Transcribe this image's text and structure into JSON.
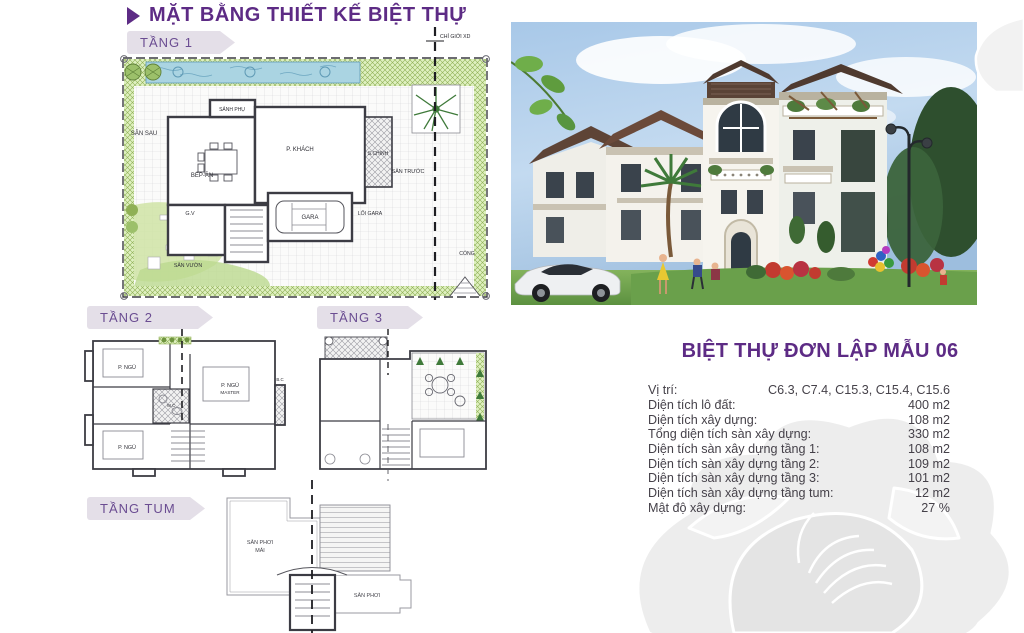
{
  "header": {
    "title": "MẶT BẰNG THIẾT KẾ BIỆT THỰ"
  },
  "floors": {
    "tang1": {
      "label": "TẦNG 1"
    },
    "tang2": {
      "label": "TẦNG 2"
    },
    "tang3": {
      "label": "TẦNG 3"
    },
    "tangtum": {
      "label": "TẦNG TUM"
    }
  },
  "plan1": {
    "boundary_note": "CHỈ GIỚI XD",
    "rooms": {
      "san_sau": "SÂN SAU",
      "bep_an": "BẾP-ĂN",
      "sanh_phu": "SẢNH PHỤ",
      "p_khach": "P. KHÁCH",
      "s_chinh": "S.CHÍNH",
      "gv": "G.V",
      "gara": "GARA",
      "loi_gara": "LỐI GARA",
      "san_vuon": "SÂN VƯỜN",
      "san_truoc": "SÂN TRƯỚC",
      "cong": "CỔNG"
    }
  },
  "plan2": {
    "rooms": {
      "bed1": "P. NGỦ",
      "bed2": "P. NGỦ",
      "master1": "P. NGỦ",
      "master2": "MASTER",
      "wc": "W.C",
      "balcony": "B.C"
    }
  },
  "plantum": {
    "rooms": {
      "left1": "SÂN PHƠI",
      "left2": "MÁI",
      "right": "SÂN PHƠI"
    }
  },
  "specs": {
    "title": "BIỆT THỰ ĐƠN LẬP MẪU 06",
    "rows": [
      {
        "label": "Vị trí:",
        "value": "C6.3, C7.4, C15.3, C15.4, C15.6"
      },
      {
        "label": "Diện tích lô đất:",
        "value": "400 m2"
      },
      {
        "label": "Diện tích xây dựng:",
        "value": "108 m2"
      },
      {
        "label": "Tổng diện tích sàn xây dựng:",
        "value": "330 m2"
      },
      {
        "label": "Diện tích sàn xây dựng tầng 1:",
        "value": "108 m2"
      },
      {
        "label": "Diện tích sàn xây dựng tầng 2:",
        "value": "109 m2"
      },
      {
        "label": "Diện tích sàn xây dựng tầng 3:",
        "value": "101 m2"
      },
      {
        "label": "Diện tích sàn xây dựng tầng tum:",
        "value": "12 m2"
      },
      {
        "label": "Mật độ xây dựng:",
        "value": "27 %"
      }
    ]
  },
  "colors": {
    "accent_purple": "#5d2b85",
    "banner_bg": "#e4dfe8",
    "banner_text": "#6b4d92",
    "plan_green": "#dff0c0",
    "pool_blue": "#aad4e2",
    "body_text": "#454149",
    "watermark_gray": "#ededed"
  }
}
